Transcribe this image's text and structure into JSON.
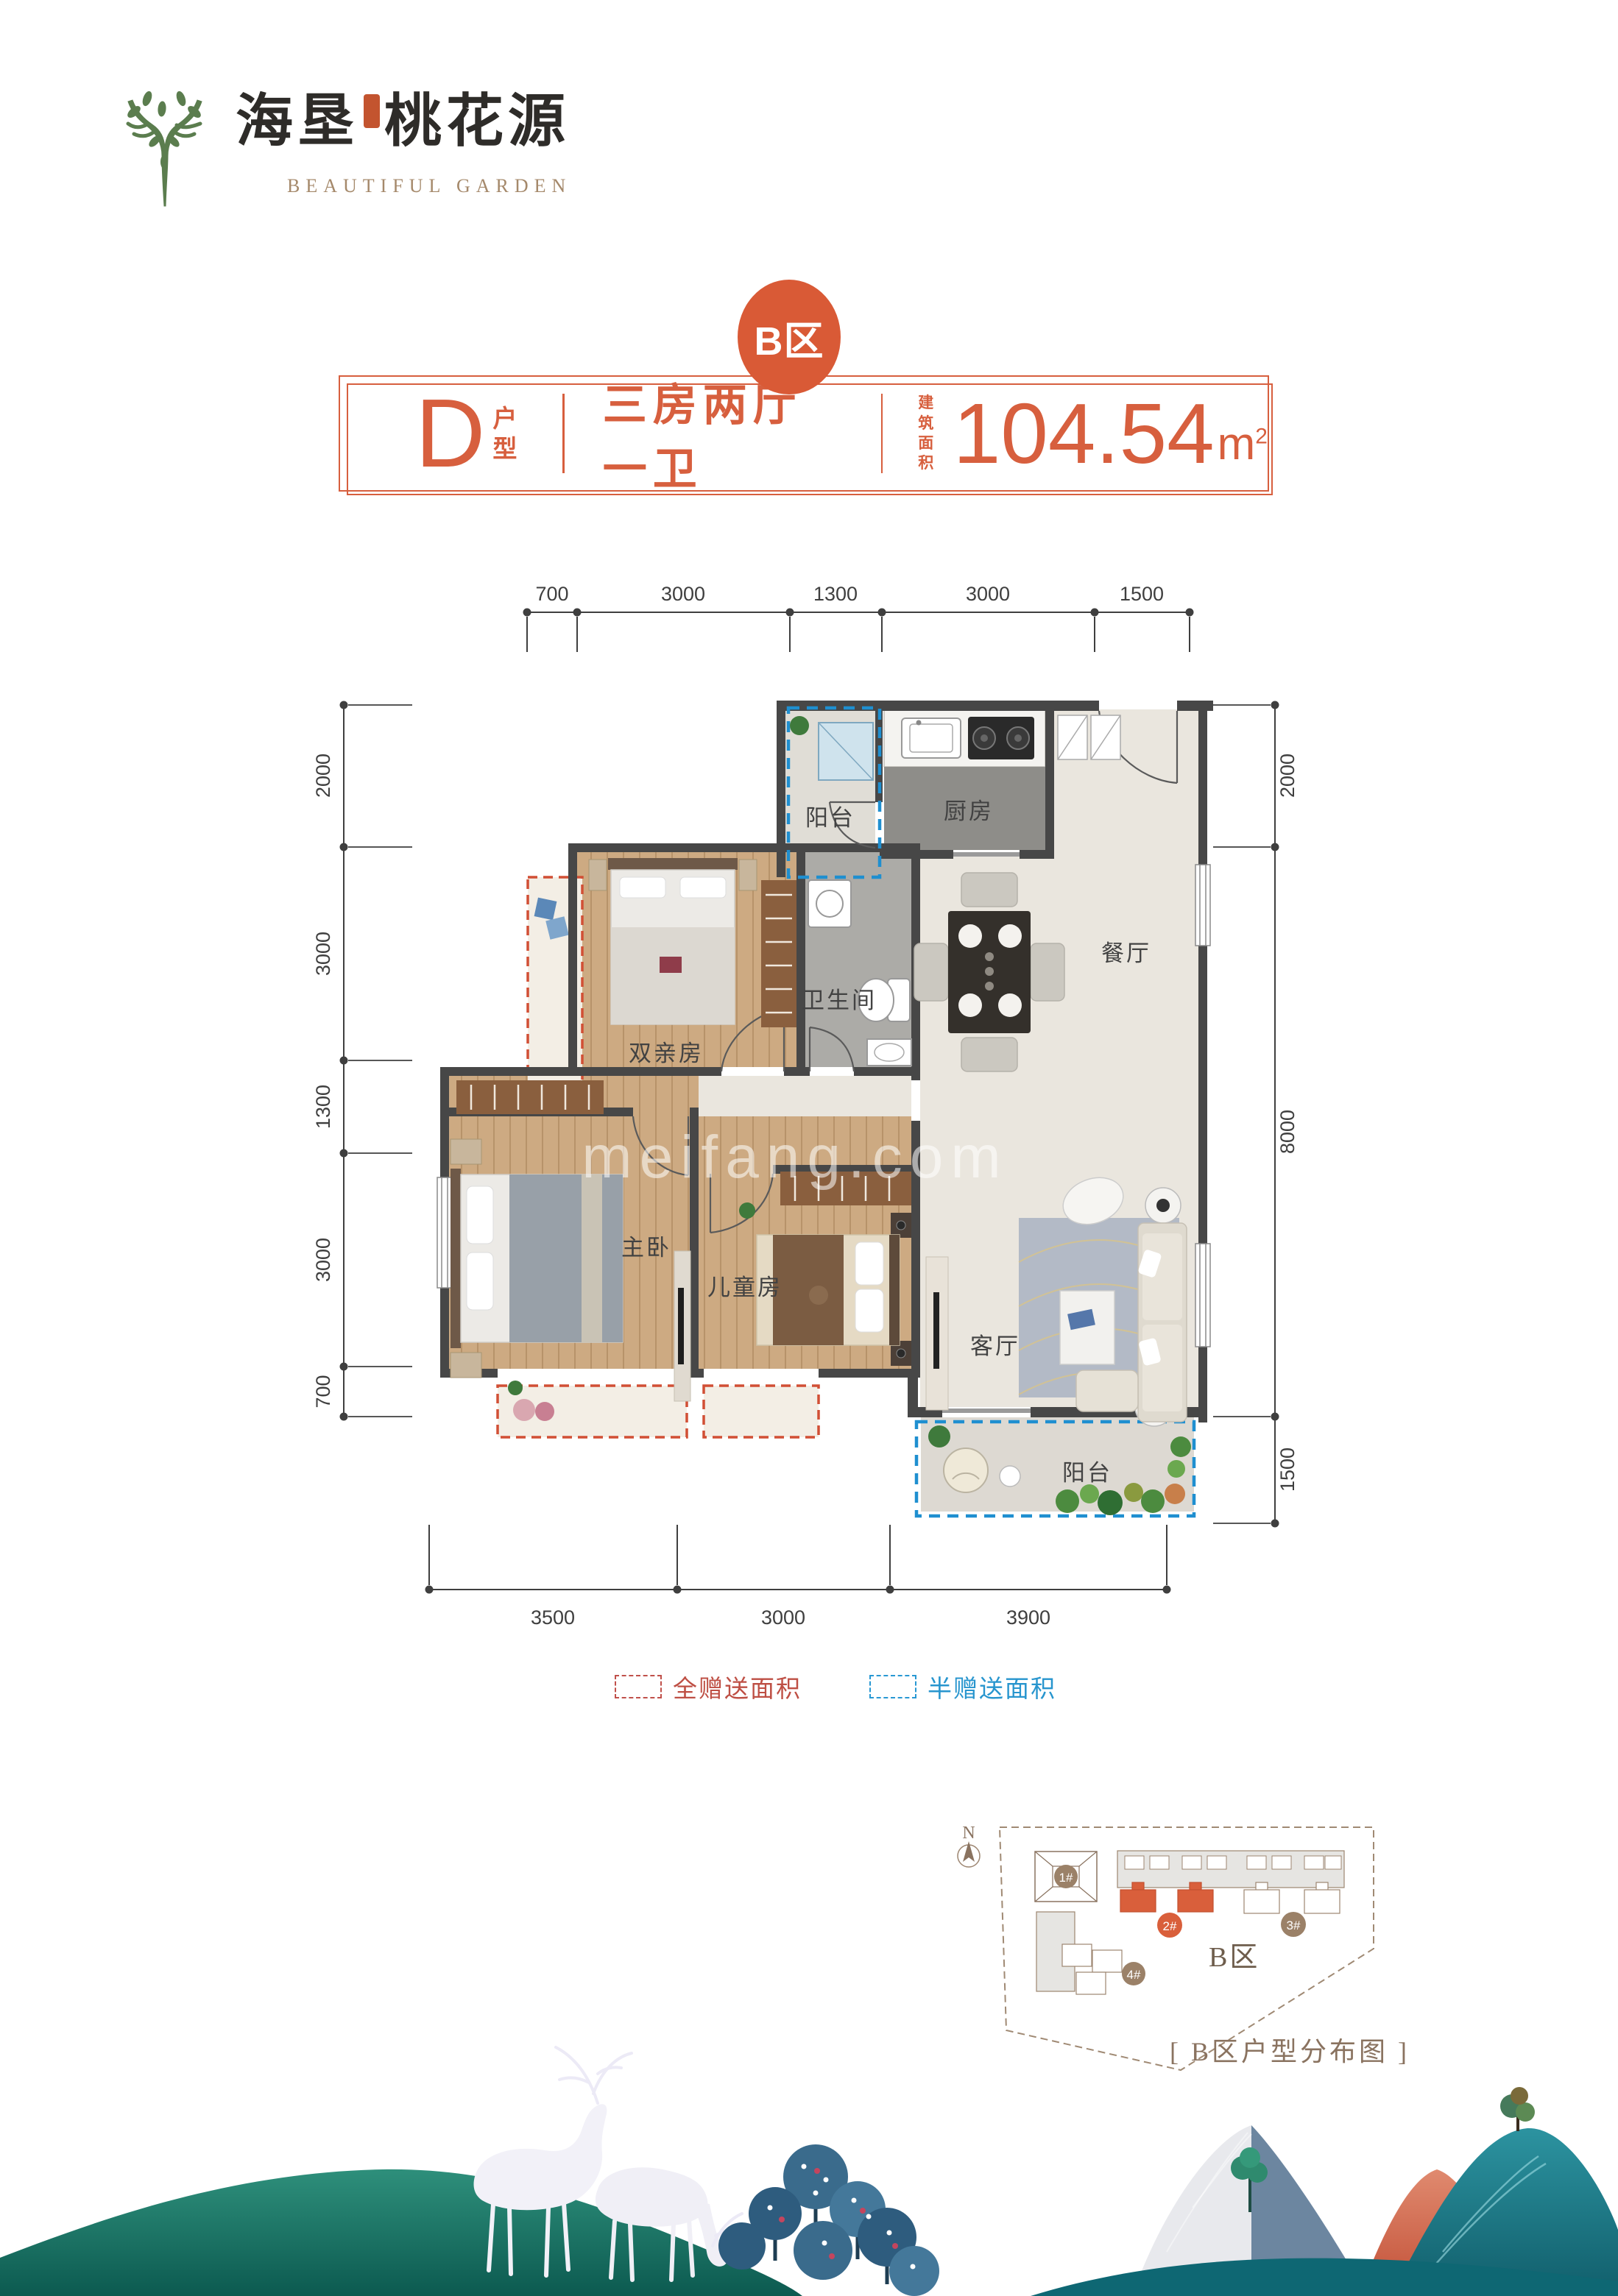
{
  "logo": {
    "cn_part1": "海垦",
    "cn_part2": "桃花源",
    "en": "BEAUTIFUL GARDEN",
    "tree_color": "#5b7d4e"
  },
  "title_banner": {
    "badge": "B区",
    "unit_letter": "D",
    "unit_suffix_line1": "户",
    "unit_suffix_line2": "型",
    "rooms_text": "三房两厅一卫",
    "area_label_line1": "建筑",
    "area_label_line2": "面积",
    "area_value": "104.54",
    "area_unit": "m",
    "area_exp": "2",
    "accent_color": "#d75f3e"
  },
  "floorplan": {
    "dims_top": [
      "700",
      "3000",
      "1300",
      "3000",
      "1500"
    ],
    "dims_left": [
      "2000",
      "3000",
      "1300",
      "3000",
      "700"
    ],
    "dims_right": [
      "2000",
      "8000",
      "1500"
    ],
    "dims_bottom": [
      "3500",
      "3000",
      "3900"
    ],
    "rooms": [
      {
        "id": "balcony-north",
        "name": "阳台"
      },
      {
        "id": "kitchen",
        "name": "厨房"
      },
      {
        "id": "dining-room",
        "name": "餐厅"
      },
      {
        "id": "parents-room",
        "name": "双亲房"
      },
      {
        "id": "bathroom",
        "name": "卫生间"
      },
      {
        "id": "master-bedroom",
        "name": "主卧"
      },
      {
        "id": "kids-room",
        "name": "儿童房"
      },
      {
        "id": "living-room",
        "name": "客厅"
      },
      {
        "id": "balcony-south",
        "name": "阳台"
      }
    ],
    "watermark": "meifang.com",
    "wall_color": "#474747",
    "full_gift_color": "#d14f35",
    "half_gift_color": "#1f8fd0"
  },
  "legend": {
    "items": [
      {
        "label": "全赠送面积",
        "color": "#c0504a"
      },
      {
        "label": "半赠送面积",
        "color": "#2898d3"
      }
    ]
  },
  "sitemap": {
    "north_label": "N",
    "area_label": "B区",
    "caption": "[ B区户型分布图 ]",
    "buildings": [
      {
        "label": "1#",
        "highlight": false
      },
      {
        "label": "2#",
        "highlight": true
      },
      {
        "label": "3#",
        "highlight": false
      },
      {
        "label": "4#",
        "highlight": false
      }
    ],
    "highlight_color": "#d95f3b",
    "line_color": "#9c8570"
  }
}
